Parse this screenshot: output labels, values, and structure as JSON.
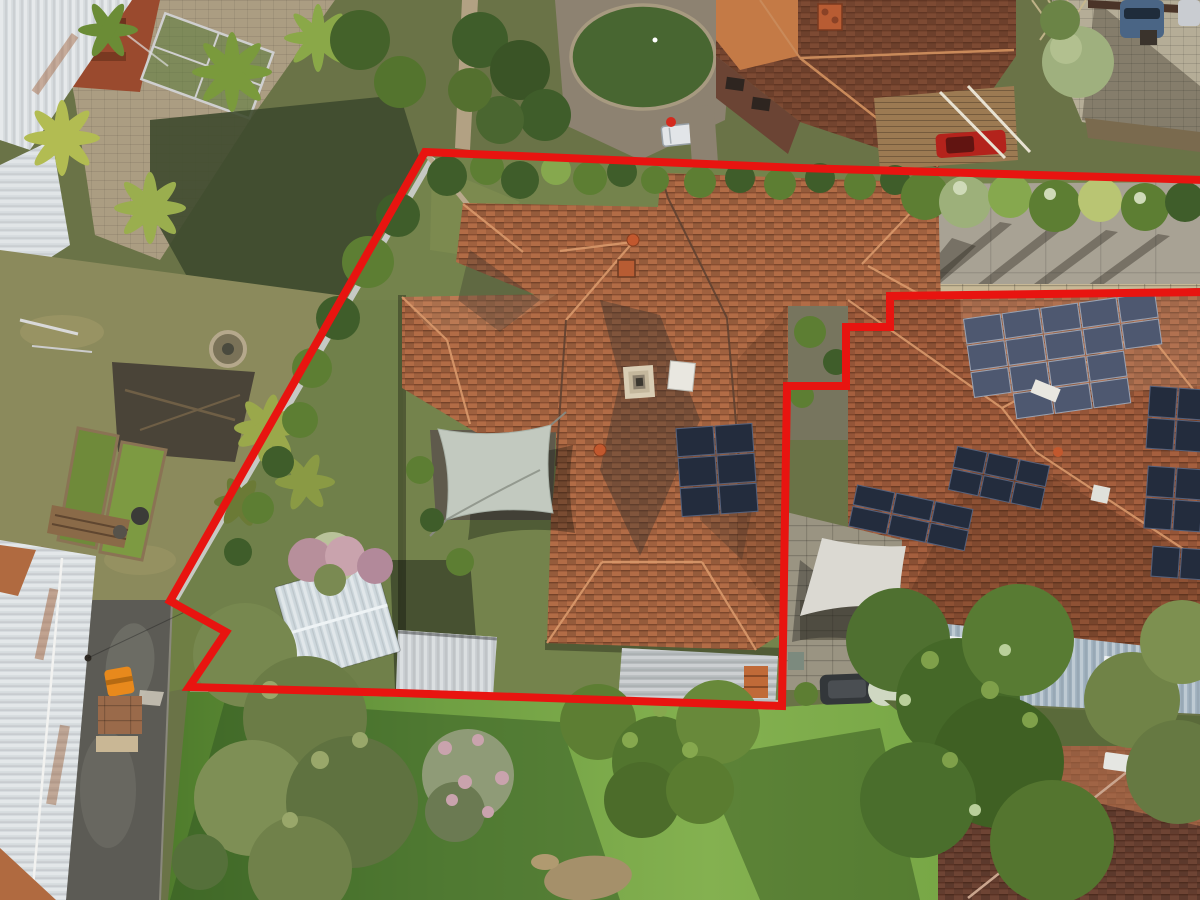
{
  "scene": {
    "description": "Top-down aerial drone photograph of a suburban property outlined with a thick red boundary line; terracotta hip-roofed house with solar panels and a grey shade sail inside the boundary, neighbouring tiled-roof houses with large solar arrays to the east, lush gardens, palm trees, a rear lawn with large trees, and a narrow laneway at lower left.",
    "style": "real-estate listing aerial photo"
  },
  "boundary": {
    "color": "#e81410",
    "stroke_width": 8,
    "points": "425,152 800,168 1206,180 1206,292 890,296 890,327 846,327 846,386 787,386 782,706 400,693 189,687 226,632 170,601"
  },
  "visible_facts": {
    "main_house_solar_panels": 6,
    "right_house_main_array_panels": 17,
    "shade_sails": 2,
    "skylights_main_house": 1,
    "cars_visible": 4
  },
  "colors": {
    "ground_base": "#6a7347",
    "lawn_shadow": "#2f5322",
    "neighbor_grass": "#8b8a5c",
    "roof_main": "#b26c46",
    "roof_right": "#a55f3e",
    "roof_dark_neighbor": "#7d4a33",
    "roof_orange_neighbor": "#c47a46",
    "roof_bottom_right": "#6e4434",
    "metal_roof_light": "#d6dbde",
    "metal_roof_blue": "#9fb0bd",
    "shed_roof": "#cdd7dc",
    "garage_roof": "#c8cdd0",
    "leanto_roof": "#b7bcbe",
    "paving_tan": "#ab9d82",
    "paving_pavers": "#b5ad97",
    "paving_grey": "#8d8271",
    "concrete": "#a8a294",
    "stone_wall": "#c7b896",
    "courtyard_stone": "#9a9482",
    "road_asphalt": "#5c5b55",
    "solar_dark": "#232c3d",
    "solar_light": "#4e5870",
    "sail_left": "#c2c9bf",
    "sail_right": "#dbd9d2",
    "tree_dark": "#3f5d2a",
    "tree_mid": "#5d7e33",
    "tree_light": "#86a84e",
    "tree_olive": "#77884f",
    "palm_yellow": "#b2bc52",
    "pink_bloom": "#c9a3ad",
    "brick_red": "#9a4a2e",
    "brick_wall_dark": "#6b4434",
    "timber_deck": "#9c7a52",
    "car_red": "#b3231c",
    "car_blue": "#4a6585",
    "car_dark": "#33373a",
    "car_silver": "#c9ccd1",
    "orange_equipment": "#e8891c",
    "trailer_white": "#e2e5e8",
    "skylight_cream": "#d9cdb4",
    "hatch_white": "#e9e7e0",
    "chimney_orange": "#b85c33",
    "fence_light": "#c6c9c4",
    "fence_bottom": "#b9b4a4",
    "terracotta_pots": "#c06a38",
    "circle_lawn": "#486631",
    "dirt_patch": "#a5906a",
    "interior_garden": "#74834c"
  }
}
